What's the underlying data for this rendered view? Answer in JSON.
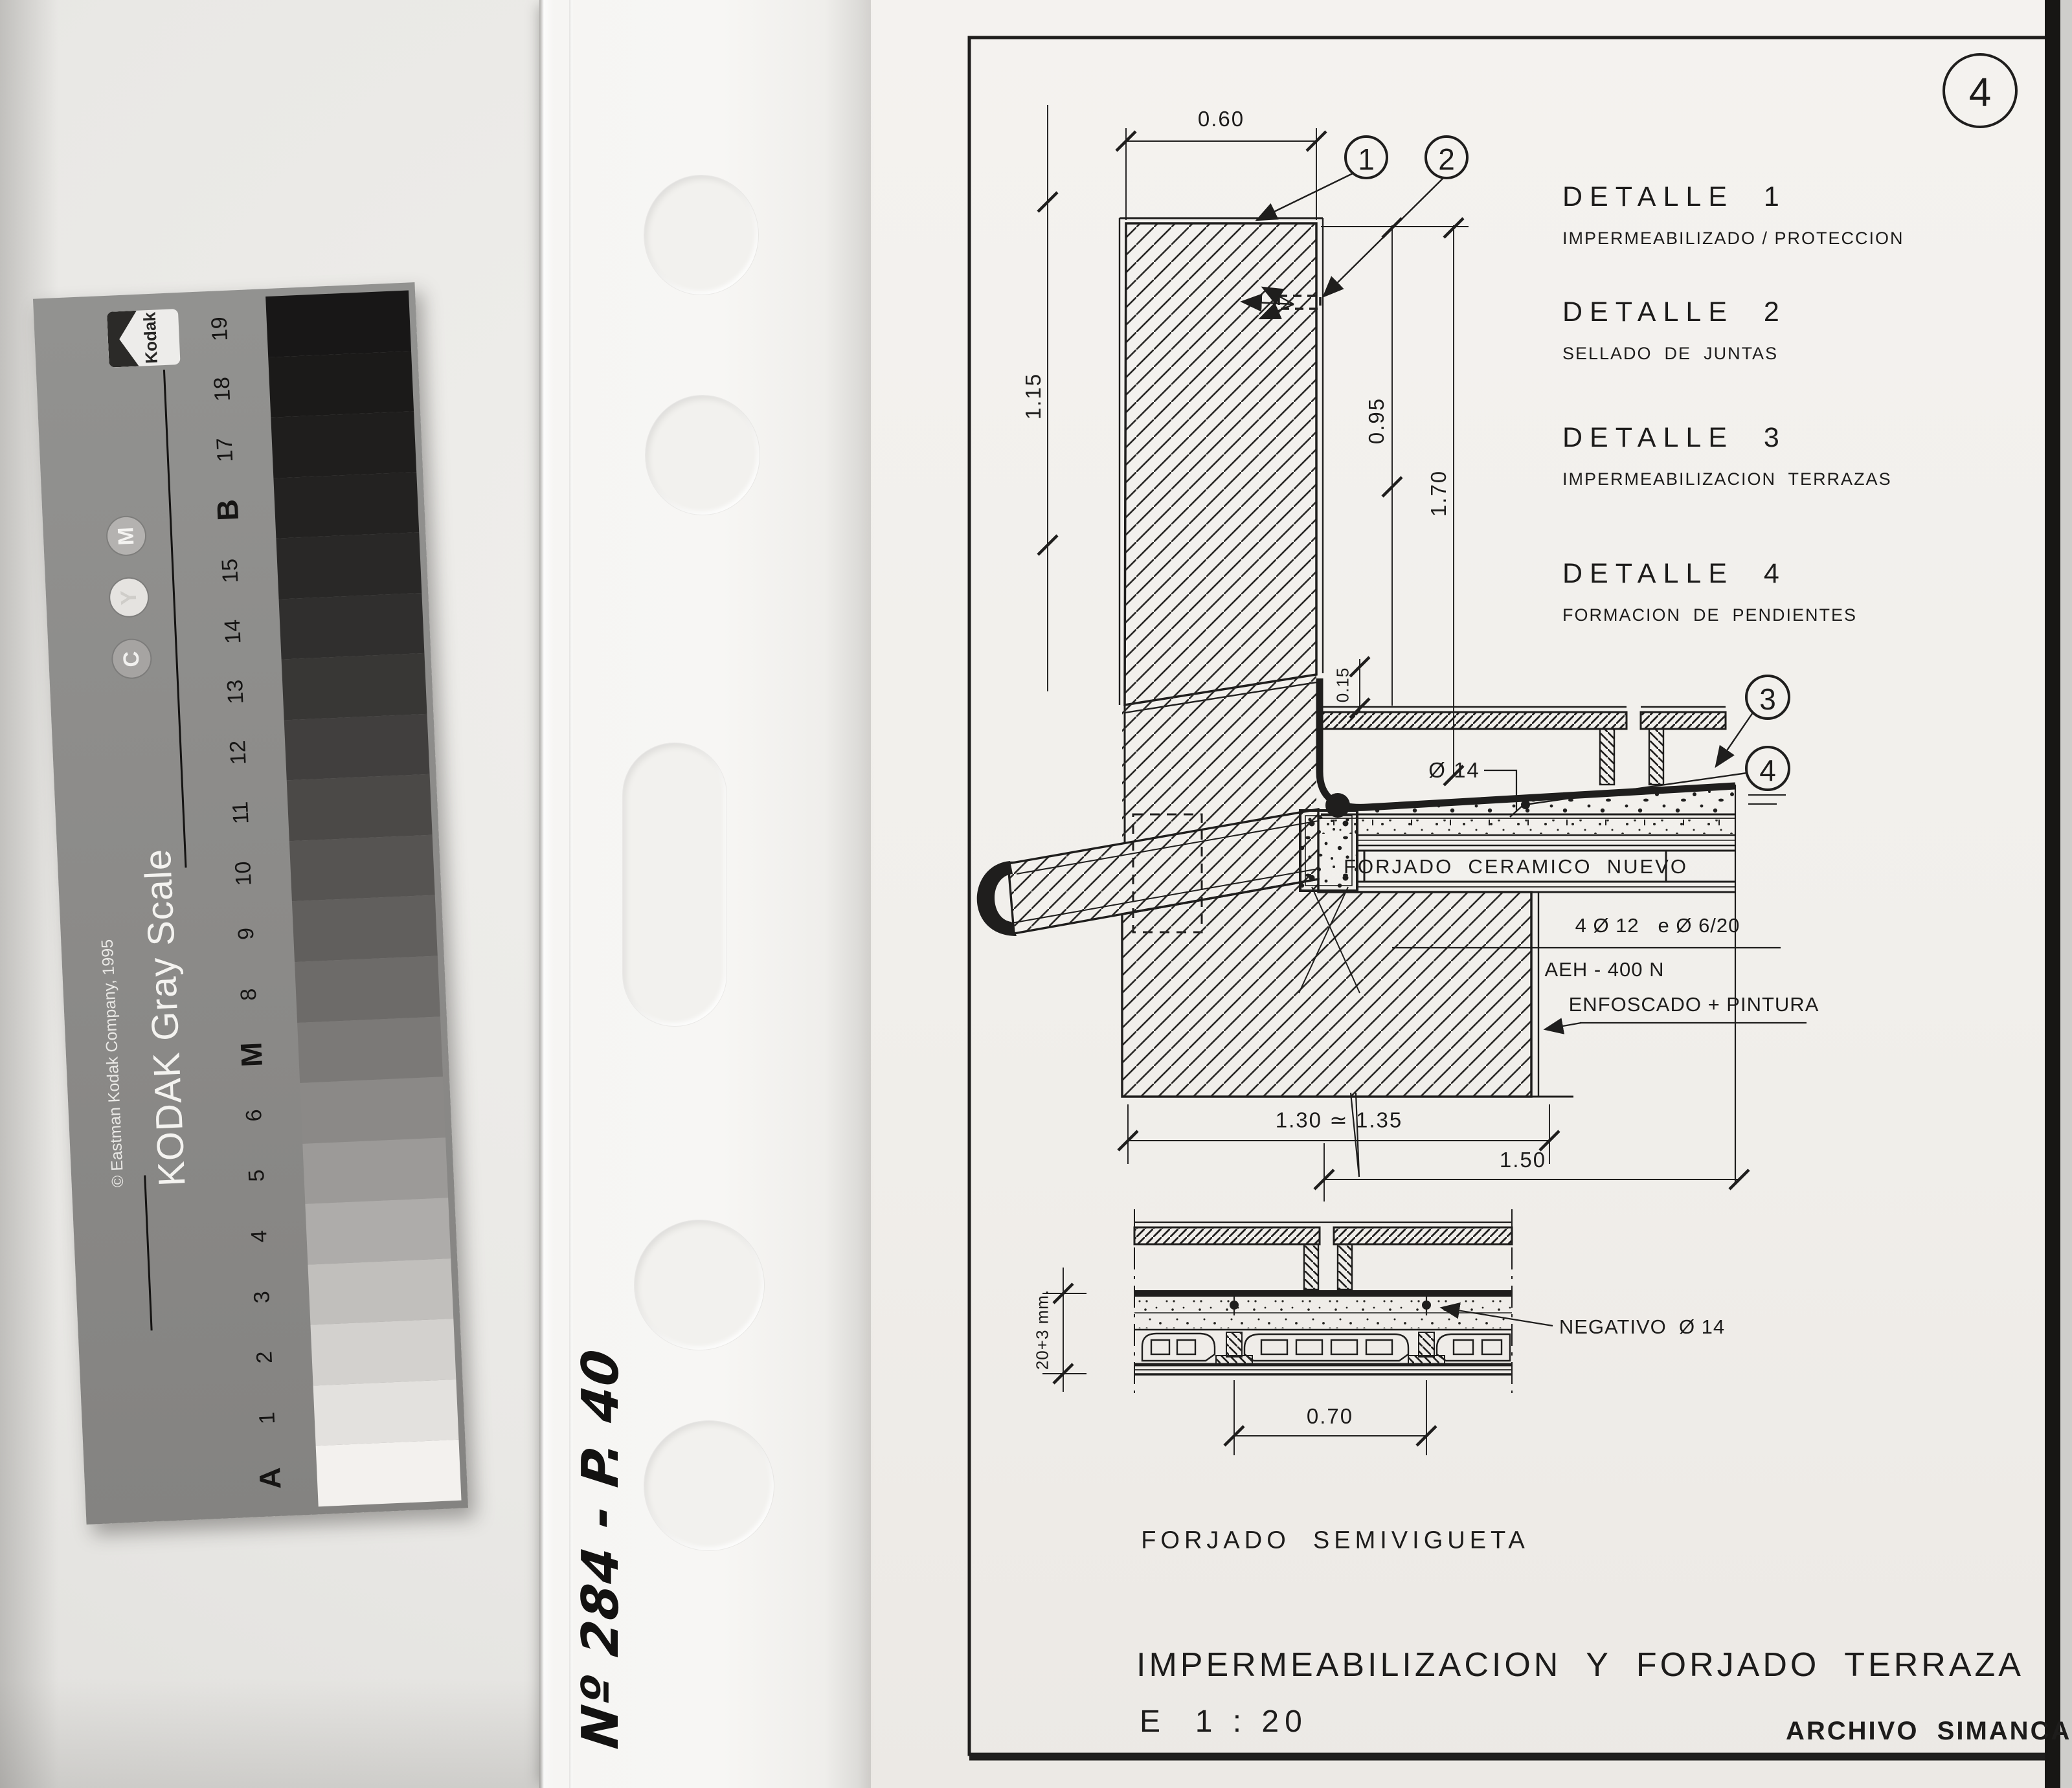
{
  "kodak_card": {
    "brand": "Kodak",
    "title": "KODAK Gray Scale",
    "copyright": "© Eastman Kodak Company, 1995",
    "registration_letters": [
      "M",
      "Y",
      "C"
    ],
    "scale_labels_top_to_bottom": [
      "19",
      "18",
      "17",
      "B",
      "15",
      "14",
      "13",
      "12",
      "11",
      "10",
      "9",
      "8",
      "M",
      "6",
      "5",
      "4",
      "3",
      "2",
      "1",
      "A"
    ],
    "patch_grays_top_to_bottom": [
      "#181717",
      "#1b1a19",
      "#1f1e1d",
      "#232221",
      "#292827",
      "#302f2e",
      "#383735",
      "#413f3e",
      "#4b4947",
      "#565452",
      "#615f5d",
      "#6d6b69",
      "#7b7977",
      "#8b8987",
      "#9c9a98",
      "#aeacaa",
      "#c1bfbc",
      "#d3d1ce",
      "#e3e1de",
      "#f3f1ee"
    ]
  },
  "handwritten_note": "Nº 284 - P. 40",
  "sheet": {
    "page_number": "4",
    "legend": [
      {
        "title": "DETALLE  1",
        "subtitle": "IMPERMEABILIZADO / PROTECCION"
      },
      {
        "title": "DETALLE  2",
        "subtitle": "SELLADO  DE  JUNTAS"
      },
      {
        "title": "DETALLE  3",
        "subtitle": "IMPERMEABILIZACION  TERRAZAS"
      },
      {
        "title": "DETALLE  4",
        "subtitle": "FORMACION  DE  PENDIENTES"
      }
    ],
    "callouts": [
      "1",
      "2",
      "3",
      "4"
    ],
    "labels": {
      "forjado_nuevo": "FORJADO  CERAMICO  NUEVO",
      "rebar": "4 Ø 12   e Ø 6/20",
      "steel_grade": "AEH - 400 N",
      "wall_finish": "ENFOSCADO + PINTURA",
      "negative_rebar": "NEGATIVO  Ø 14",
      "section_name": "FORJADO  SEMIVIGUETA"
    },
    "dimensions": {
      "parapet_width": "0.60",
      "parapet_height_left": "1.15",
      "parapet_height_right": "0.95",
      "total_height": "1.70",
      "coping": "0.15",
      "drain_diameter": "Ø 14",
      "wall_thickness": "1.30 ≃ 1.35",
      "slab_span": "1.50",
      "joist_spacing": "0.70",
      "slab_thickness": "20+3 mm."
    },
    "title_block": {
      "title": "IMPERMEABILIZACION  Y  FORJADO  TERRAZA",
      "scale": "E  1 : 20",
      "archive": "ARCHIVO  SIMANCAS"
    }
  },
  "colors": {
    "ink": "#1f1e1d",
    "paper": "#f2f0ec",
    "card_gray": "#8b8a88",
    "background": "#e9e8e5",
    "frame_black": "#171614"
  }
}
